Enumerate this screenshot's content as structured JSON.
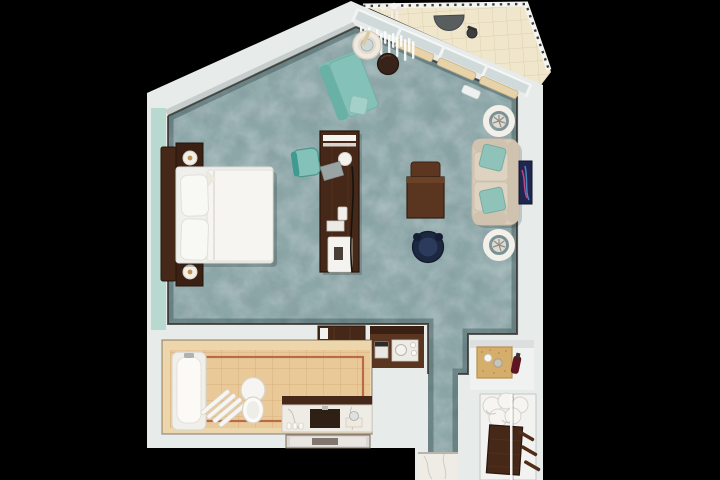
{
  "scene": {
    "type": "3d-floor-plan",
    "view": "top-down 3D render of a hotel guest room suite",
    "background": "#000000"
  },
  "colors": {
    "wall": "#e7ebea",
    "wall_shadow": "#c5cdcc",
    "carpet": "#8da7a9",
    "accent_wall": "#b7d9d0",
    "wood_dark": "#452818",
    "wood_mid": "#5a3520",
    "linen_white": "#f6f5f1",
    "teal_seat": "#84c1b8",
    "teal_pillow": "#8fc3ba",
    "cream_sofa": "#d8cbb8",
    "navy_chair": "#1c2740",
    "art_navy": "#1f2650",
    "cork": "#d5ae6c",
    "wine_red": "#5d1622",
    "marble": "#efece5",
    "brass": "#c09354",
    "bath_wall_tile": "#edd6ac",
    "bath_floor_tile": "#e9c998",
    "tile_accent": "#b05a38",
    "balcony_tile": "#efe6cc"
  },
  "areas": {
    "bedroom_living": {
      "floor": "mottled teal carpet with dark baseboard trim",
      "items": [
        "king bed with white duvet and two pillows",
        "dark wood headboard",
        "two nightstands with lamps",
        "two brass wall sconces",
        "long media console with desk lamp, folder, telephone, tray and magazine",
        "teal desk chair",
        "dark wood work table with tucked chair",
        "navy swivel tub chair",
        "teal chaise lounge",
        "round drink table with ice bucket and champagne",
        "brown leather pouf",
        "cream loveseat with two teal throw pillows",
        "two white ring side tables with sculptures",
        "abstract wall artwork",
        "low dark wood dresser"
      ]
    },
    "bathroom": {
      "floor": "beige ceramic tile with terracotta accent border",
      "items": [
        "bathtub with faucet",
        "slatted towel rack",
        "toilet",
        "marble vanity with sink, faucet, amenities and kettle tray",
        "wall mirror"
      ]
    },
    "minibar_nook": {
      "items": [
        "dark wood counter",
        "espresso machine",
        "marble tray with kettle",
        "coffee cups"
      ]
    },
    "pantry_shelf": {
      "items": [
        "rattan tray",
        "mug",
        "glass jar",
        "wine bottle"
      ]
    },
    "wardrobe": {
      "items": [
        "folded bathrobes",
        "dark wood cabinet",
        "luggage rack",
        "sliding door edge"
      ]
    },
    "entry": {
      "floor": "teal carpet runner ending on marble tile"
    },
    "balcony": {
      "floor": "cream stone tile",
      "railing": "white rail with dark balusters and flower planter",
      "items": [
        "half-round table",
        "small stool"
      ]
    }
  }
}
